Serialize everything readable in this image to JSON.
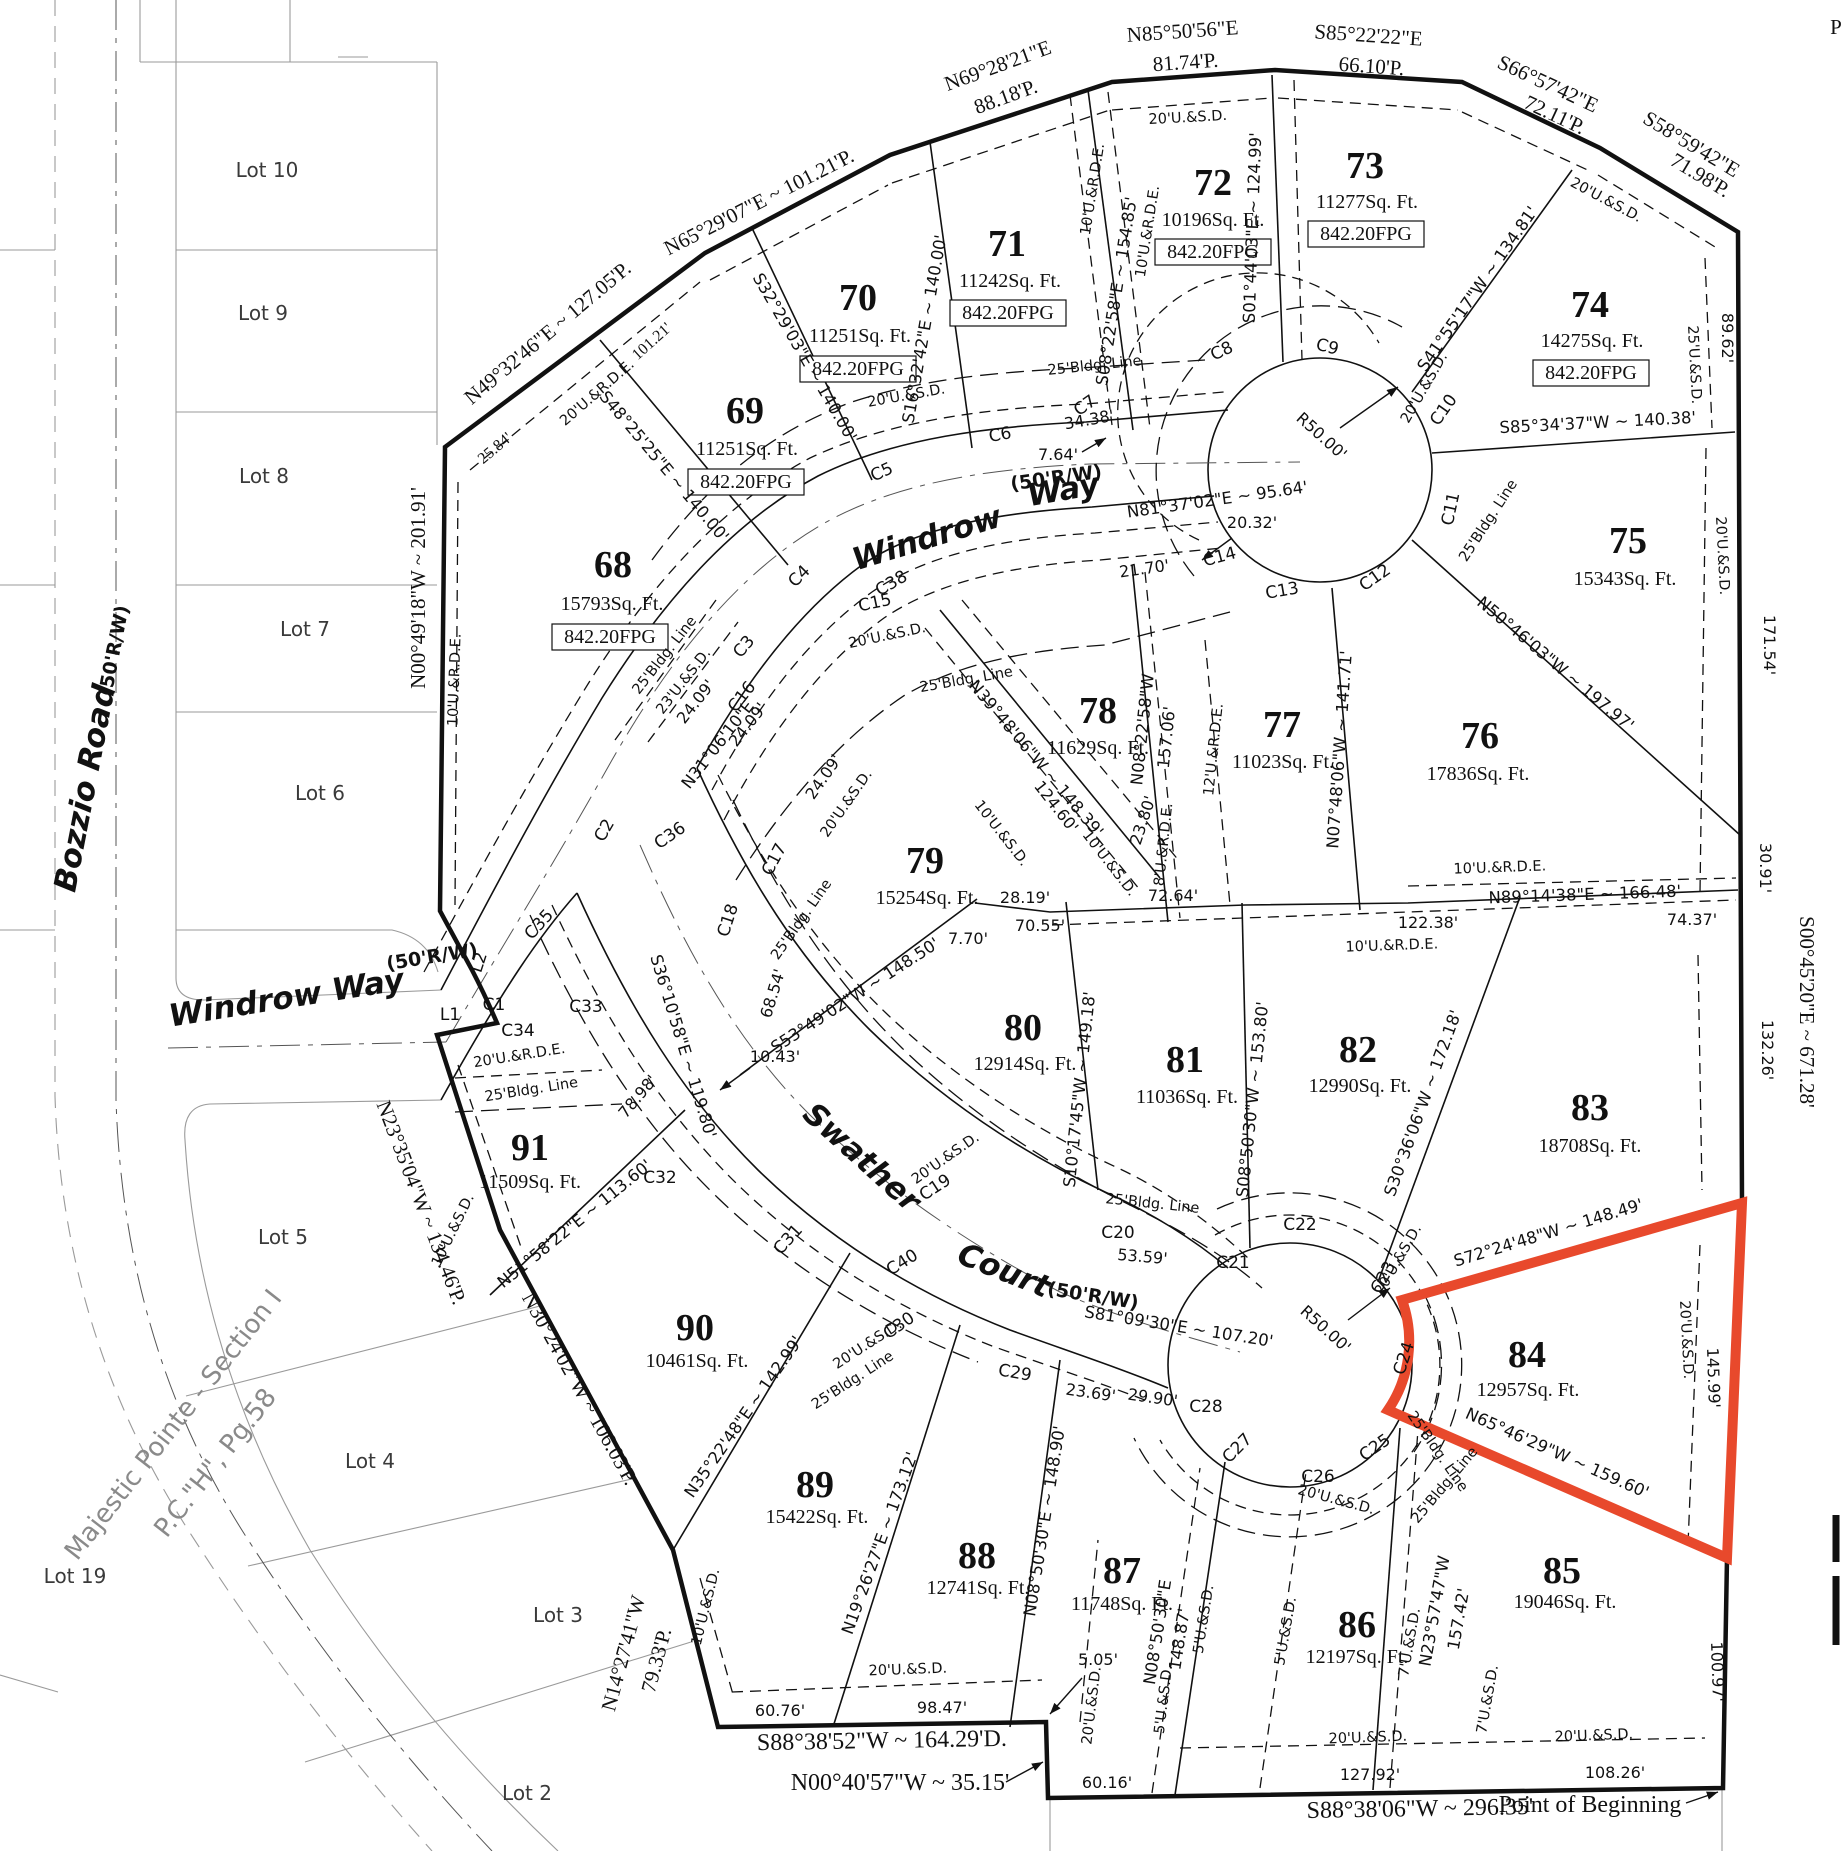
{
  "colors": {
    "highlight": "#e8492c",
    "line": "#111111",
    "adjacent_gray": "#9a9a9a"
  },
  "streets": {
    "windrow_w1": "Windrow",
    "windrow_w2": "Way",
    "windrow_left": "Windrow Way",
    "swather_w1": "Swather",
    "swather_w2": "Court",
    "bozzio": "Bozzio Road",
    "rw50": "(50'R/W)"
  },
  "adjacent": {
    "title1": "Majestic Pointe - Section I",
    "title2": "P.C.\"H\", Pg.58",
    "lot10": "Lot 10",
    "lot9": "Lot 9",
    "lot8": "Lot 8",
    "lot7": "Lot 7",
    "lot6": "Lot 6",
    "lot5": "Lot 5",
    "lot4": "Lot 4",
    "lot3": "Lot 3",
    "lot2": "Lot 2",
    "lot19": "Lot 19"
  },
  "lots": [
    {
      "n": "68",
      "a": "15793Sq. Ft.",
      "f": "842.20FPG"
    },
    {
      "n": "69",
      "a": "11251Sq. Ft.",
      "f": "842.20FPG"
    },
    {
      "n": "70",
      "a": "11251Sq. Ft.",
      "f": "842.20FPG"
    },
    {
      "n": "71",
      "a": "11242Sq. Ft.",
      "f": "842.20FPG"
    },
    {
      "n": "72",
      "a": "10196Sq. Ft.",
      "f": "842.20FPG"
    },
    {
      "n": "73",
      "a": "11277Sq. Ft.",
      "f": "842.20FPG"
    },
    {
      "n": "74",
      "a": "14275Sq. Ft.",
      "f": "842.20FPG"
    },
    {
      "n": "75",
      "a": "15343Sq. Ft."
    },
    {
      "n": "76",
      "a": "17836Sq. Ft."
    },
    {
      "n": "77",
      "a": "11023Sq. Ft."
    },
    {
      "n": "78",
      "a": "11629Sq. Ft."
    },
    {
      "n": "79",
      "a": "15254Sq. Ft."
    },
    {
      "n": "80",
      "a": "12914Sq. Ft."
    },
    {
      "n": "81",
      "a": "11036Sq. Ft."
    },
    {
      "n": "82",
      "a": "12990Sq. Ft."
    },
    {
      "n": "83",
      "a": "18708Sq. Ft."
    },
    {
      "n": "84",
      "a": "12957Sq. Ft."
    },
    {
      "n": "85",
      "a": "19046Sq. Ft."
    },
    {
      "n": "86",
      "a": "12197Sq. Ft."
    },
    {
      "n": "87",
      "a": "11748Sq. Ft."
    },
    {
      "n": "88",
      "a": "12741Sq. Ft."
    },
    {
      "n": "89",
      "a": "15422Sq. Ft."
    },
    {
      "n": "90",
      "a": "10461Sq. Ft."
    },
    {
      "n": "91",
      "a": "11509Sq. Ft."
    }
  ],
  "boundary": {
    "n49": "N49°32'46\"E ~ 127.05'P.",
    "d2584": "25.84'",
    "n65": "N65°29'07\"E ~ 101.21'P.",
    "d10121": "101.21'",
    "n69a": "N69°28'21\"E",
    "n69b": "88.18'P.",
    "n85a": "N85°50'56\"E",
    "n85b": "81.74'P.",
    "s85a": "S85°22'22\"E",
    "s85b": "66.10'P.",
    "s66a": "S66°57'42\"E",
    "s66b": "72.11'P.",
    "s58a": "S58°59'42\"E",
    "s58b": "71.98'P.",
    "s00": "S00°45'20\"E ~ 671.28'",
    "s8806": "S88°38'06\"W ~ 296.35'",
    "pob": "Point of Beginning",
    "n0040": "N00°40'57\"W ~ 35.15'",
    "s8852": "S88°38'52\"W ~ 164.29'D.",
    "n14a": "N14°27'41\"W",
    "n14b": "79.33'P.",
    "n30": "N30°24'02\"W ~ 106.03'P.",
    "n23": "N23°35'04\"W ~ 134.46'P.",
    "n0049": "N00°49'18\"W ~ 201.91'"
  },
  "bearings": {
    "s48": "S48°25'25\"E ~ 140.00'",
    "s32": "S32°29'03\"E ~ 140.00'",
    "s16": "S16°32'42\"E ~ 140.00'",
    "s08": "S08°22'58\"E ~ 154.85'",
    "s01": "S01°44'03\"E ~ 124.99'",
    "s41": "S41°55'17\"W ~ 134.81'",
    "s8534": "S85°34'37\"W ~ 140.38'",
    "n50": "N50°46'03\"W ~ 197.97'",
    "n07": "N07°48'06\"W ~ 141.71'",
    "n08wa": "N08°22'58\"W",
    "n08wb": "157.06'",
    "n39": "N39°48'06\"W ~ 148.39'",
    "s53": "S53°49'02\"W ~ 148.50'",
    "s10": "S10°17'45\"W ~ 149.18'",
    "s0850": "S08°50'30\"W ~ 153.80'",
    "s30": "S30°36'06\"W ~ 172.18'",
    "n89": "N89°14'38\"E ~ 166.48'",
    "s72": "S72°24'48\"W ~ 148.49'",
    "n65w": "N65°46'29\"W ~ 159.60'",
    "n23wa": "N23°57'47\"W",
    "n23wb": "157.42'",
    "n0850e": "N08°50'30\"E ~ 148.90'",
    "n0850ea": "N08°50'30\"E",
    "n0850eb": "148.87'",
    "n19": "N19°26'27\"E ~ 173.12'",
    "n35": "N35°22'48\"E ~ 142.99'",
    "n51": "N51°58'22\"E ~ 113.60'",
    "n31": "N31°06'10\"E",
    "s36": "S36°10'58\"E ~ 119.80'",
    "n81": "N81°37'02\"E ~ 95.64'",
    "s81": "S81°09'30\"E ~ 107.20'"
  },
  "dims": {
    "r50": "R50.00'",
    "d764": "7.64'",
    "d3438": "34.38'",
    "d2032": "20.32'",
    "d2170": "21.70'",
    "d2409": "24.09'",
    "d6854": "68.54'",
    "d7898": "78.98'",
    "d1043": "10.43'",
    "d770": "7.70'",
    "d2380": "23.80'",
    "d12460": "124.60'",
    "d2819": "28.19'",
    "d7264": "72.64'",
    "d7055": "70.55'",
    "d12238": "122.38'",
    "d7437": "74.37'",
    "d3091": "30.91'",
    "d8962": "89.62'",
    "d17154": "171.54'",
    "d13226": "132.26'",
    "d14599": "145.99'",
    "d10097": "100.97'",
    "d5359": "53.59'",
    "d2369": "23.69'",
    "d2990": "29.90'",
    "d6076": "60.76'",
    "d9847": "98.47'",
    "d505": "5.05'",
    "d6016": "60.16'",
    "d12792": "127.92'",
    "d10826": "108.26'"
  },
  "easements": {
    "u20sd": "20'U.&S.D.",
    "u10rde": "10'U.&R.D.E.",
    "u20rde": "20'U.&R.D.E.",
    "bldg": "25'Bldg. Line",
    "u10sd": "10'U.&S.D.",
    "u23sd": "23'U.&S.D.",
    "u12rde": "12'U.&R.D.E.",
    "u8rde": "8'U.&R.D.E.",
    "u5sd": "5'U.&S.D.",
    "u7sd": "7'U.&S.D.",
    "u25sd": "25'U.&S.D."
  },
  "curves": {
    "c1": "C1",
    "c2": "C2",
    "c3": "C3",
    "c4": "C4",
    "c5": "C5",
    "c6": "C6",
    "c7": "C7",
    "c8": "C8",
    "c9": "C9",
    "c10": "C10",
    "c11": "C11",
    "c12": "C12",
    "c13": "C13",
    "c14": "C14",
    "c15": "C15",
    "c16": "C16",
    "c17": "C17",
    "c18": "C18",
    "c19": "C19",
    "c20": "C20",
    "c21": "C21",
    "c22": "C22",
    "c23": "C23",
    "c24": "C24",
    "c25": "C25",
    "c26": "C26",
    "c27": "C27",
    "c28": "C28",
    "c29": "C29",
    "c30": "C30",
    "c31": "C31",
    "c32": "C32",
    "c33": "C33",
    "c34": "C34",
    "c35": "C35",
    "c36": "C36",
    "c38": "C38",
    "c40": "C40",
    "l1": "L1",
    "l2": "L2"
  },
  "misc": {
    "p": "P"
  }
}
